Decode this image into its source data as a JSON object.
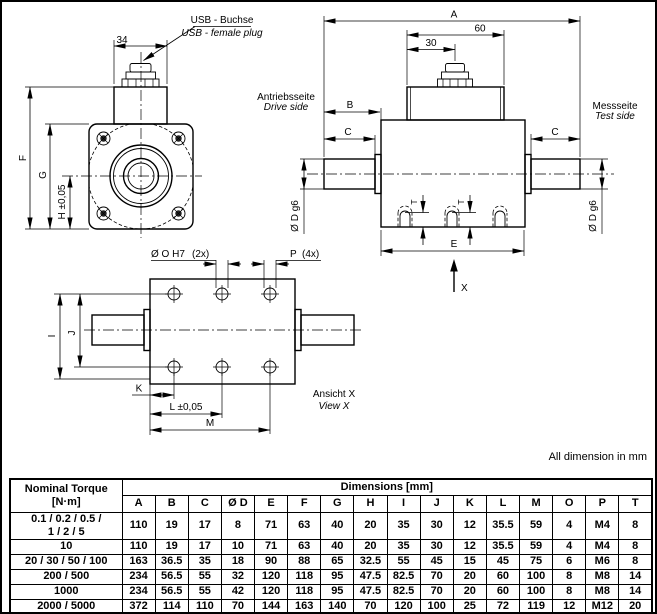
{
  "drawing": {
    "front_view": {
      "usb_label_de": "USB - Buchse",
      "usb_label_en": "USB - female plug",
      "width_dim": "34",
      "dim_f": "F",
      "dim_g": "G",
      "dim_h": "H ±0,05"
    },
    "side_view": {
      "dim_a": "A",
      "dim_60": "60",
      "dim_30": "30",
      "dim_b": "B",
      "dim_c_left": "C",
      "dim_c_right": "C",
      "drive_de": "Antriebsseite",
      "drive_en": "Drive side",
      "test_de": "Messseite",
      "test_en": "Test side",
      "dia_left": "Ø D g6",
      "dia_right": "Ø D g6",
      "dim_e": "E",
      "dim_t_1": "T",
      "dim_t_2": "T",
      "view_x": "X"
    },
    "bottom_view": {
      "hole_label": "Ø O H7",
      "hole_count": "(2x)",
      "thread_label": "P",
      "thread_count": "(4x)",
      "dim_i": "I",
      "dim_j": "J",
      "dim_k": "K",
      "dim_l": "L ±0,05",
      "dim_m": "M",
      "view_de": "Ansicht X",
      "view_en": "View X"
    },
    "note": "All dimension in mm"
  },
  "table": {
    "torque_header": "Nominal Torque\n[N·m]",
    "group_header": "Dimensions [mm]",
    "dim_headers": [
      "A",
      "B",
      "C",
      "Ø D",
      "E",
      "F",
      "G",
      "H",
      "I",
      "J",
      "K",
      "L",
      "M",
      "O",
      "P",
      "T"
    ],
    "rows": [
      {
        "torque": "0.1 / 0.2 / 0.5 /\n1 / 2 / 5",
        "values": [
          "110",
          "19",
          "17",
          "8",
          "71",
          "63",
          "40",
          "20",
          "35",
          "30",
          "12",
          "35.5",
          "59",
          "4",
          "M4",
          "8"
        ]
      },
      {
        "torque": "10",
        "values": [
          "110",
          "19",
          "17",
          "10",
          "71",
          "63",
          "40",
          "20",
          "35",
          "30",
          "12",
          "35.5",
          "59",
          "4",
          "M4",
          "8"
        ]
      },
      {
        "torque": "20 / 30 / 50 / 100",
        "values": [
          "163",
          "36.5",
          "35",
          "18",
          "90",
          "88",
          "65",
          "32.5",
          "55",
          "45",
          "15",
          "45",
          "75",
          "6",
          "M6",
          "8"
        ]
      },
      {
        "torque": "200 / 500",
        "values": [
          "234",
          "56.5",
          "55",
          "32",
          "120",
          "118",
          "95",
          "47.5",
          "82.5",
          "70",
          "20",
          "60",
          "100",
          "8",
          "M8",
          "14"
        ]
      },
      {
        "torque": "1000",
        "values": [
          "234",
          "56.5",
          "55",
          "42",
          "120",
          "118",
          "95",
          "47.5",
          "82.5",
          "70",
          "20",
          "60",
          "100",
          "8",
          "M8",
          "14"
        ]
      },
      {
        "torque": "2000 / 5000",
        "values": [
          "372",
          "114",
          "110",
          "70",
          "144",
          "163",
          "140",
          "70",
          "120",
          "100",
          "25",
          "72",
          "119",
          "12",
          "M12",
          "20"
        ]
      }
    ]
  }
}
